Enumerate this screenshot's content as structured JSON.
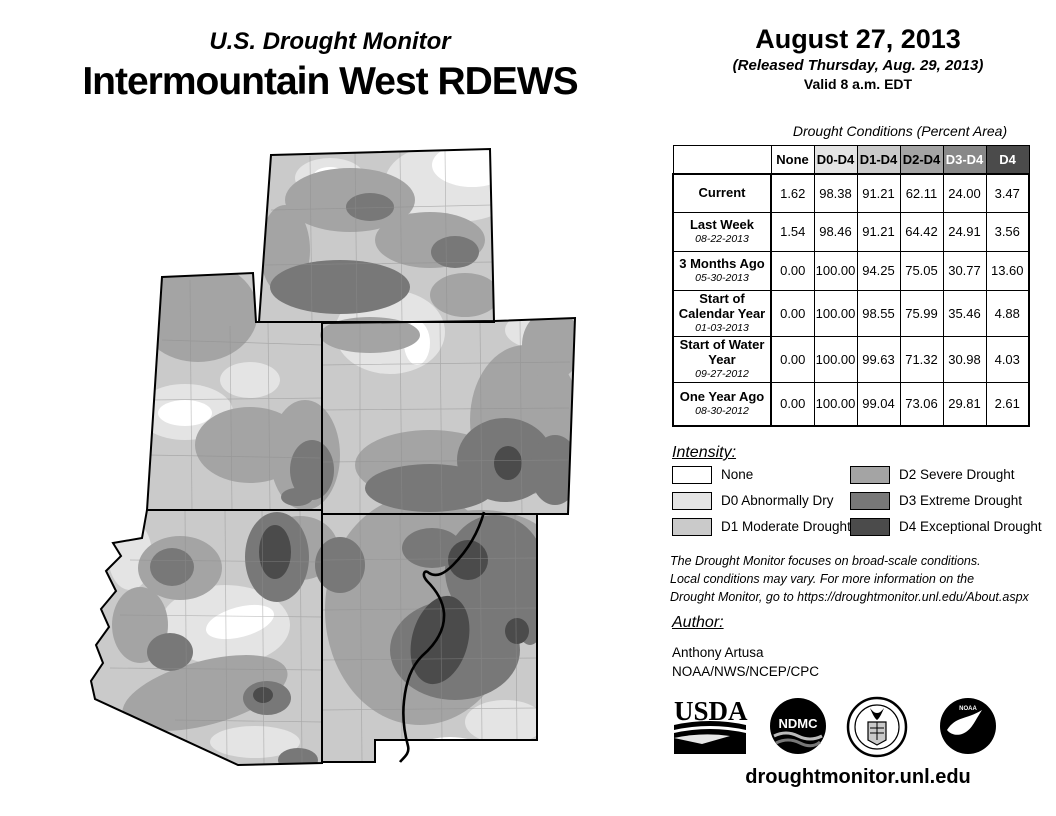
{
  "titles": {
    "monitor": "U.S. Drought Monitor",
    "region": "Intermountain West RDEWS"
  },
  "date_block": {
    "date": "August 27, 2013",
    "released": "(Released Thursday, Aug. 29, 2013)",
    "valid": "Valid 8 a.m. EDT"
  },
  "table": {
    "title": "Drought Conditions (Percent Area)",
    "columns": [
      "None",
      "D0-D4",
      "D1-D4",
      "D2-D4",
      "D3-D4",
      "D4"
    ],
    "rows": [
      {
        "label": "Current",
        "date": "",
        "values": [
          "1.62",
          "98.38",
          "91.21",
          "62.11",
          "24.00",
          "3.47"
        ]
      },
      {
        "label": "Last Week",
        "date": "08-22-2013",
        "values": [
          "1.54",
          "98.46",
          "91.21",
          "64.42",
          "24.91",
          "3.56"
        ]
      },
      {
        "label": "3 Months Ago",
        "date": "05-30-2013",
        "values": [
          "0.00",
          "100.00",
          "94.25",
          "75.05",
          "30.77",
          "13.60"
        ]
      },
      {
        "label": "Start of Calendar Year",
        "date": "01-03-2013",
        "values": [
          "0.00",
          "100.00",
          "98.55",
          "75.99",
          "35.46",
          "4.88"
        ]
      },
      {
        "label": "Start of Water Year",
        "date": "09-27-2012",
        "values": [
          "0.00",
          "100.00",
          "99.63",
          "71.32",
          "30.98",
          "4.03"
        ]
      },
      {
        "label": "One Year Ago",
        "date": "08-30-2012",
        "values": [
          "0.00",
          "100.00",
          "99.04",
          "73.06",
          "29.81",
          "2.61"
        ]
      }
    ]
  },
  "legend": {
    "title": "Intensity:",
    "items": [
      {
        "code": "none",
        "label": "None",
        "color": "#ffffff"
      },
      {
        "code": "d0",
        "label": "D0 Abnormally Dry",
        "color": "#e4e4e4"
      },
      {
        "code": "d1",
        "label": "D1 Moderate Drought",
        "color": "#cacaca"
      },
      {
        "code": "d2",
        "label": "D2 Severe Drought",
        "color": "#a4a4a4"
      },
      {
        "code": "d3",
        "label": "D3 Extreme Drought",
        "color": "#787878"
      },
      {
        "code": "d4",
        "label": "D4 Exceptional Drought",
        "color": "#4b4b4b"
      }
    ]
  },
  "notes": {
    "line1": "The Drought Monitor focuses on broad-scale conditions.",
    "line2": "Local conditions may vary. For more information on the",
    "line3": "Drought Monitor, go to https://droughtmonitor.unl.edu/About.aspx"
  },
  "author": {
    "heading": "Author:",
    "name": "Anthony Artusa",
    "org": "NOAA/NWS/NCEP/CPC"
  },
  "logos": {
    "usda": "USDA",
    "ndmc": "NDMC",
    "doc": "U.S. Department of Commerce seal",
    "noaa": "NOAA"
  },
  "footer": {
    "website": "droughtmonitor.unl.edu"
  }
}
